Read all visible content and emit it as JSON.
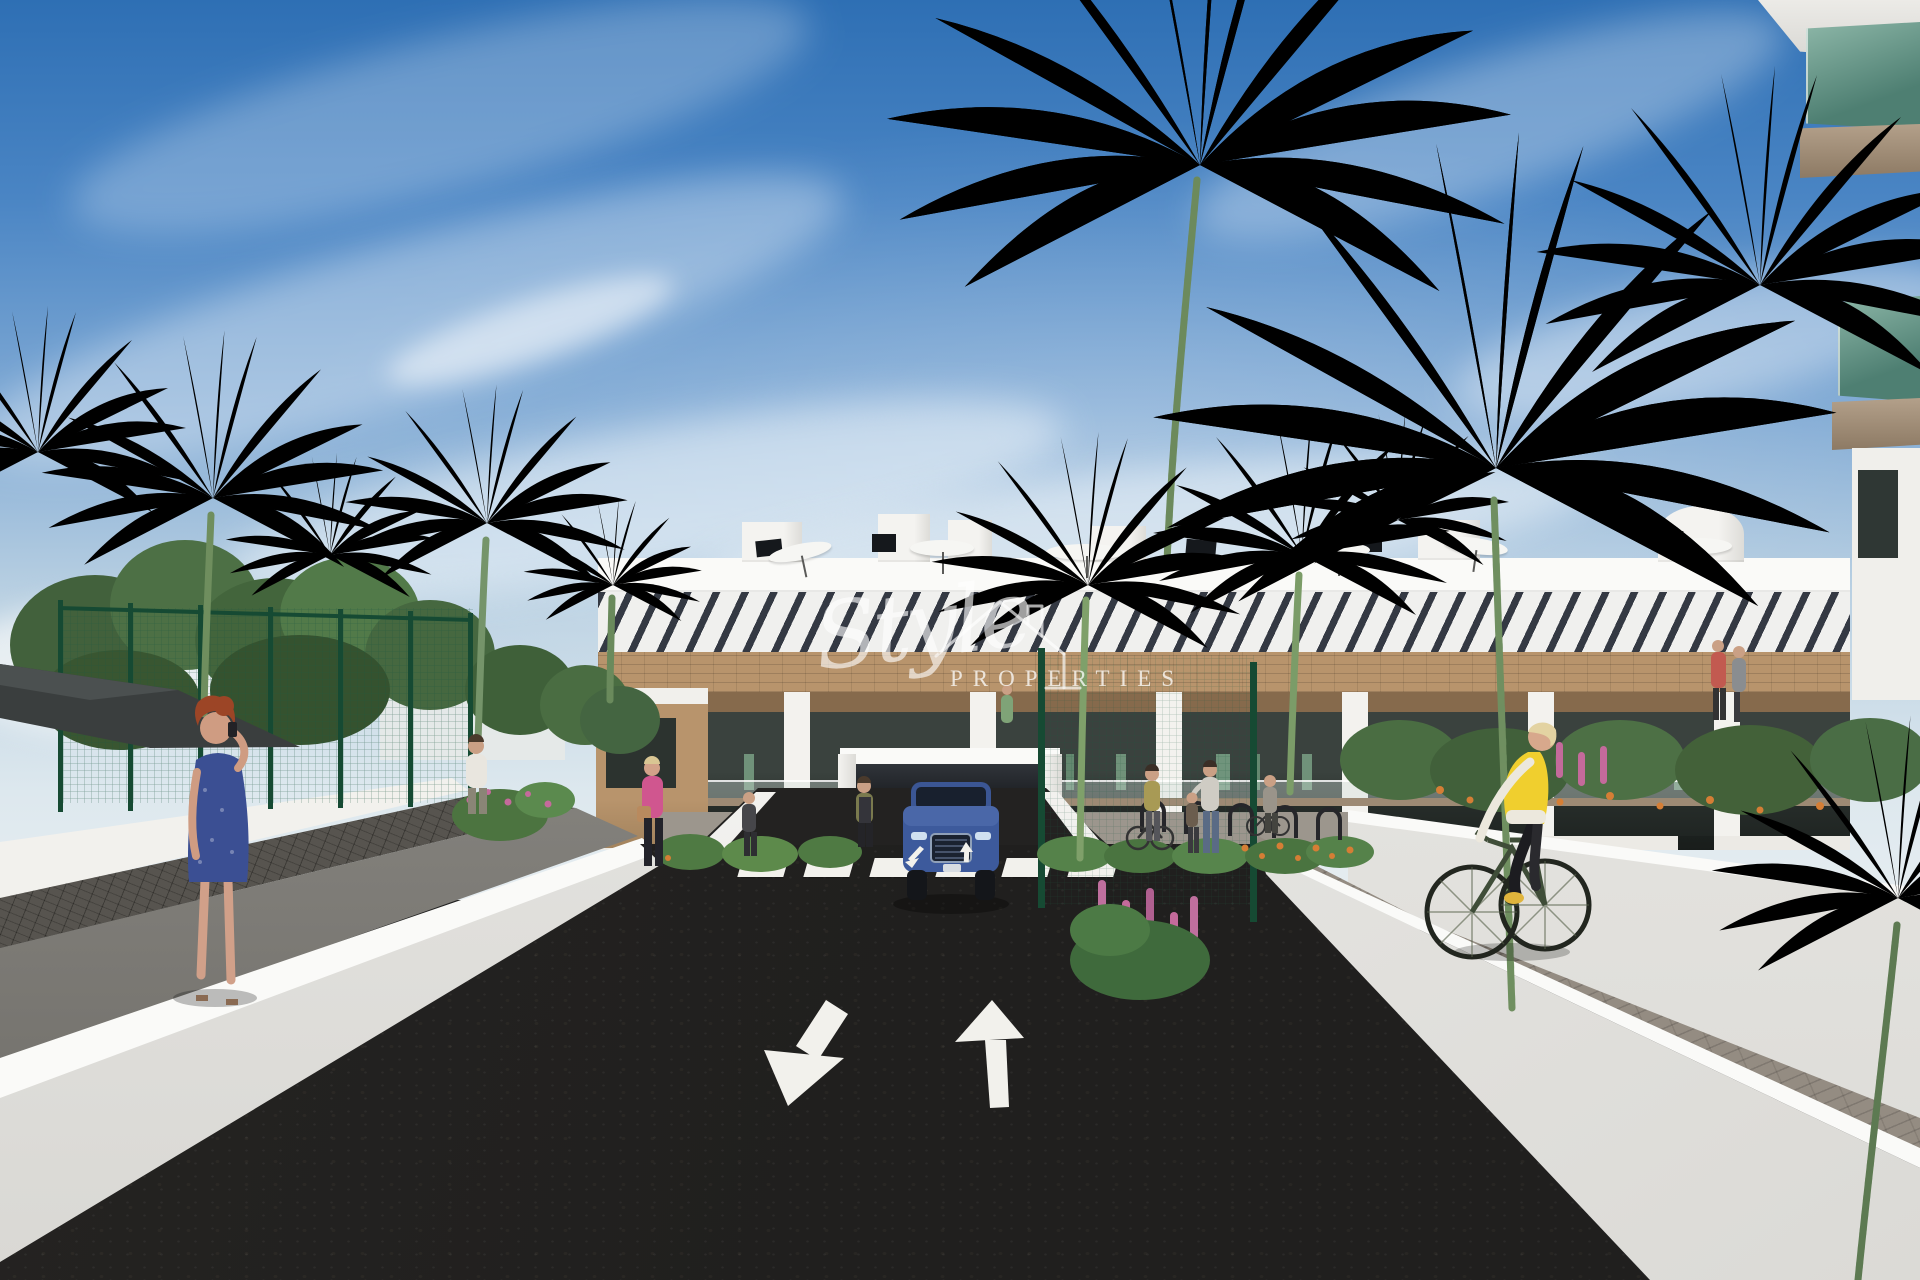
{
  "watermark": {
    "script_text": "Style",
    "caps_text": "PROPERTIES",
    "icon": "house-outline-icon",
    "color": "#ffffff",
    "opacity": 0.7
  },
  "road_markings": {
    "crosswalk_stripe_count": 6,
    "lane_arrows": [
      "toward-viewer-down-left",
      "away-from-viewer-up"
    ],
    "ramp_arrows": [
      "down",
      "up"
    ]
  },
  "scene_inventory": [
    "sky-with-clouds",
    "apartment-building",
    "rooftop-parasols",
    "rooftop-solar-panels",
    "pergola-louvres",
    "wood-cladding-band",
    "balconies-with-glass-railings",
    "garage-entrance",
    "blue-suv",
    "asphalt-road",
    "zebra-crosswalk",
    "lane-direction-arrows",
    "white-low-walls",
    "left-sidewalk",
    "right-paver-walkway",
    "woman-on-phone",
    "cyclist-yellow-vest",
    "pedestrians",
    "bike-racks",
    "palm-trees",
    "leafy-trees",
    "green-mesh-fence",
    "shade-sail",
    "flower-beds",
    "foreground-balcony-building",
    "watermark"
  ],
  "palette": {
    "sky_top": "#2e6fb4",
    "sky_mid": "#7fa9d4",
    "sky_horizon": "#dde8ee",
    "building_white": "#f3f2ee",
    "building_shadow": "#d9d8d4",
    "pergola_dark": "#414650",
    "wood": "#b8946c",
    "wood_dark": "#8f6f4e",
    "glass_dark": "#2f3734",
    "glass_teal": "#5f9484",
    "fascia_tan": "#9d8a74",
    "road": "#201f1e",
    "marking_white": "#f2f1ec",
    "wall_white": "#fafaf8",
    "wall_face": "#e9e8e4",
    "sidewalk": "#96948f",
    "pavers": "#948c82",
    "tile": "#57544f",
    "tree_dark": "#3d5c38",
    "tree_mid": "#527245",
    "palm_green": "#6f8e5e",
    "trunk": "#7d6b53",
    "fence_green": "#1f5c40",
    "flower_orange": "#d57e35",
    "flower_pink": "#c46a9b",
    "car_blue": "#3d5a9c",
    "vest_yellow": "#f0cf2e",
    "dress_blue": "#3b4f93",
    "hair_red": "#9c4526",
    "skin": "#d2a289"
  }
}
